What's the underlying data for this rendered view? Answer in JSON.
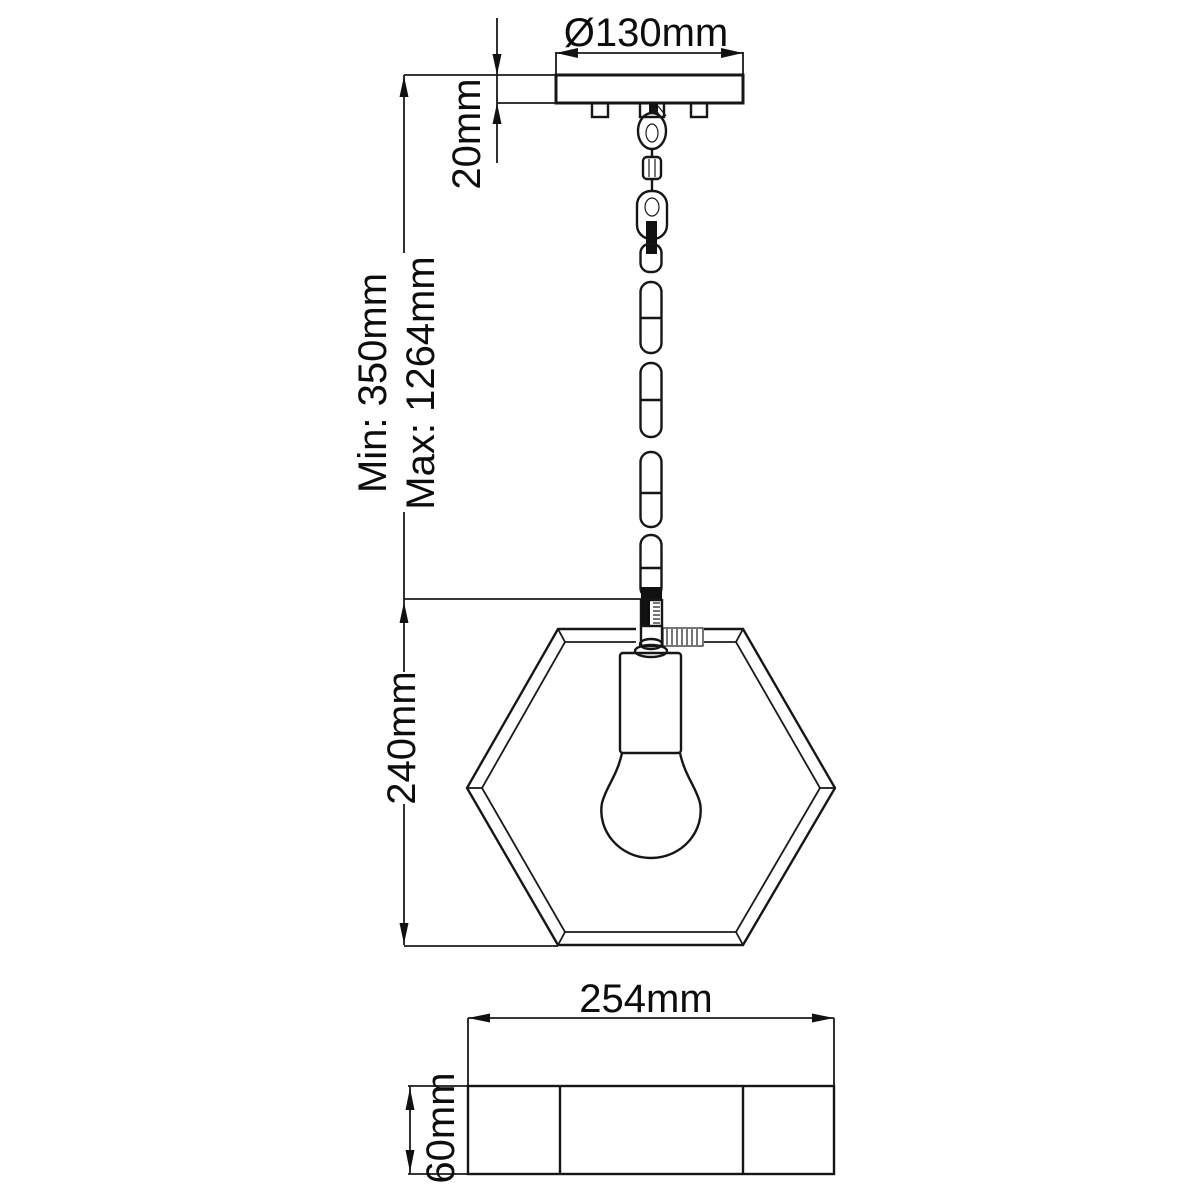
{
  "drawing": {
    "type": "technical-dimension-diagram",
    "subject": "hexagonal pendant light, side view and bottom view",
    "labels": {
      "canopy_diameter": "Ø130mm",
      "canopy_height": "20mm",
      "drop_min": "Min: 350mm",
      "drop_max": "Max: 1264mm",
      "fixture_height": "240mm",
      "fixture_width": "254mm",
      "base_height": "60mm"
    },
    "colors": {
      "line": "#161616",
      "text": "#0d0d0d",
      "background": "#ffffff"
    }
  }
}
